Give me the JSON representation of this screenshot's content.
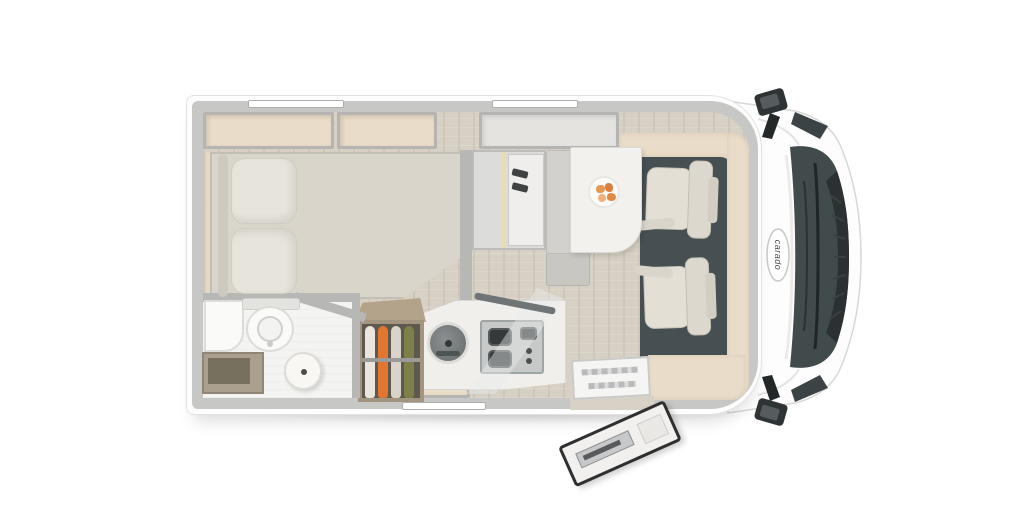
{
  "brand": {
    "logo_text": "carado"
  },
  "vehicle": {
    "view": "top-down floor plan render",
    "front_direction": "right",
    "door_state": "open"
  },
  "colors": {
    "background": "#ffffff",
    "body_wall_gray": "#c7c7c6",
    "body_white": "#fdfdfd",
    "floor_wood": "#d7d0c4",
    "interior_trim_beige": "#e9dcc8",
    "cab_floor_dark": "#465052",
    "seat_cream": "#e3dfd5",
    "mattress_gray": "#d9d5cb",
    "pillow": "#e7e4dc",
    "table_white": "#f2f1ed",
    "windshield_dark": "#404a4a",
    "wardrobe_wood": "#b3a38b",
    "clothes_orange": "#e2762e",
    "clothes_olive": "#7f7f4a",
    "clothes_white": "#eae6de",
    "food_orange": "#e89750",
    "hob_gray": "#c7c9c9",
    "sink_gray": "#75797a"
  },
  "items": {
    "rear_bed": "french-bed",
    "bed_pillows": 2,
    "overhead_shelves": 2,
    "bathroom": [
      "toilet",
      "corner-basin",
      "round-washbasin",
      "bench-cabinet"
    ],
    "wardrobe_clothes": 4,
    "kitchen": [
      "round-sink",
      "three-burner-hob",
      "glass-splash-panel",
      "base-cabinet"
    ],
    "dinette": [
      "bench-seat",
      "table",
      "plate-of-food"
    ],
    "cab": [
      "driver-seat",
      "passenger-seat",
      "dashboard",
      "windshield",
      "mirror-left",
      "mirror-right"
    ],
    "entry": [
      "step-well",
      "entry-door-open"
    ],
    "windows": 3
  }
}
